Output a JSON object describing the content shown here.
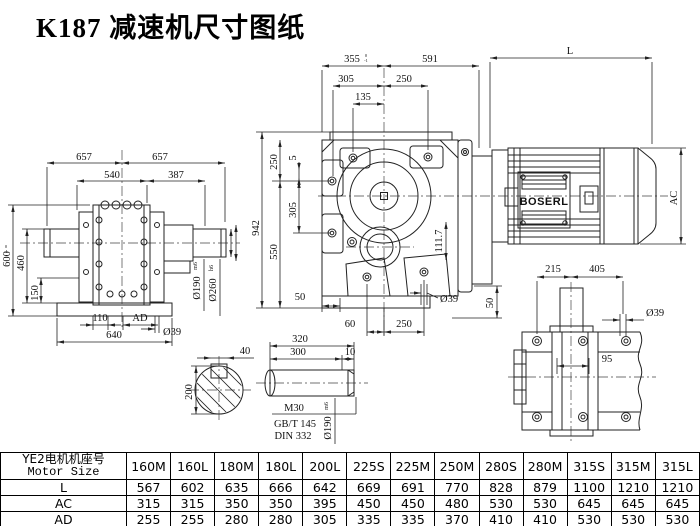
{
  "title": "K187 减速机尺寸图纸",
  "front": {
    "d657a": "657",
    "d657b": "657",
    "d540": "540",
    "d387": "387",
    "d600": "600",
    "tol_up": "0",
    "tol_dn": "-1",
    "d460": "460",
    "d150": "150",
    "d110": "110",
    "dAD": "AD",
    "d640": "640",
    "d39": "Ø39",
    "d190": "Ø190",
    "d190fit": "m6",
    "d260": "Ø260",
    "d260fit": "h6"
  },
  "main": {
    "d355": "355",
    "tol_up": "0",
    "tol_dn": "-1",
    "d591": "591",
    "d305t": "305",
    "d250t": "250",
    "d135": "135",
    "d942": "942",
    "d250l": "250",
    "d5": "5",
    "d305l": "305",
    "d550": "550",
    "d50a": "50",
    "d60": "60",
    "d250b": "250",
    "d39": "Ø39",
    "d111": "111.7",
    "d50b": "50",
    "dL": "L",
    "dAC": "AC"
  },
  "motor": {
    "brand": "BOSERL"
  },
  "foot": {
    "d215": "215",
    "d405": "405",
    "d39": "Ø39",
    "d95": "95"
  },
  "shaft": {
    "d320": "320",
    "d300": "300",
    "d10": "10",
    "thread": "M30",
    "std1": "GB/T 145",
    "std2": "DIN 332",
    "d190": "Ø190",
    "fit": "m6"
  },
  "key": {
    "d40": "40",
    "d200": "200"
  },
  "table": {
    "header_cn": "YE2电机机座号",
    "header_en": "Motor Size",
    "columns": [
      "160M",
      "160L",
      "180M",
      "180L",
      "200L",
      "225S",
      "225M",
      "250M",
      "280S",
      "280M",
      "315S",
      "315M",
      "315L"
    ],
    "rows": [
      {
        "label": "L",
        "values": [
          "567",
          "602",
          "635",
          "666",
          "642",
          "669",
          "691",
          "770",
          "828",
          "879",
          "1100",
          "1210",
          "1210"
        ]
      },
      {
        "label": "AC",
        "values": [
          "315",
          "315",
          "350",
          "350",
          "395",
          "450",
          "450",
          "480",
          "530",
          "530",
          "645",
          "645",
          "645"
        ]
      },
      {
        "label": "AD",
        "values": [
          "255",
          "255",
          "280",
          "280",
          "305",
          "335",
          "335",
          "370",
          "410",
          "410",
          "530",
          "530",
          "530"
        ]
      }
    ]
  }
}
